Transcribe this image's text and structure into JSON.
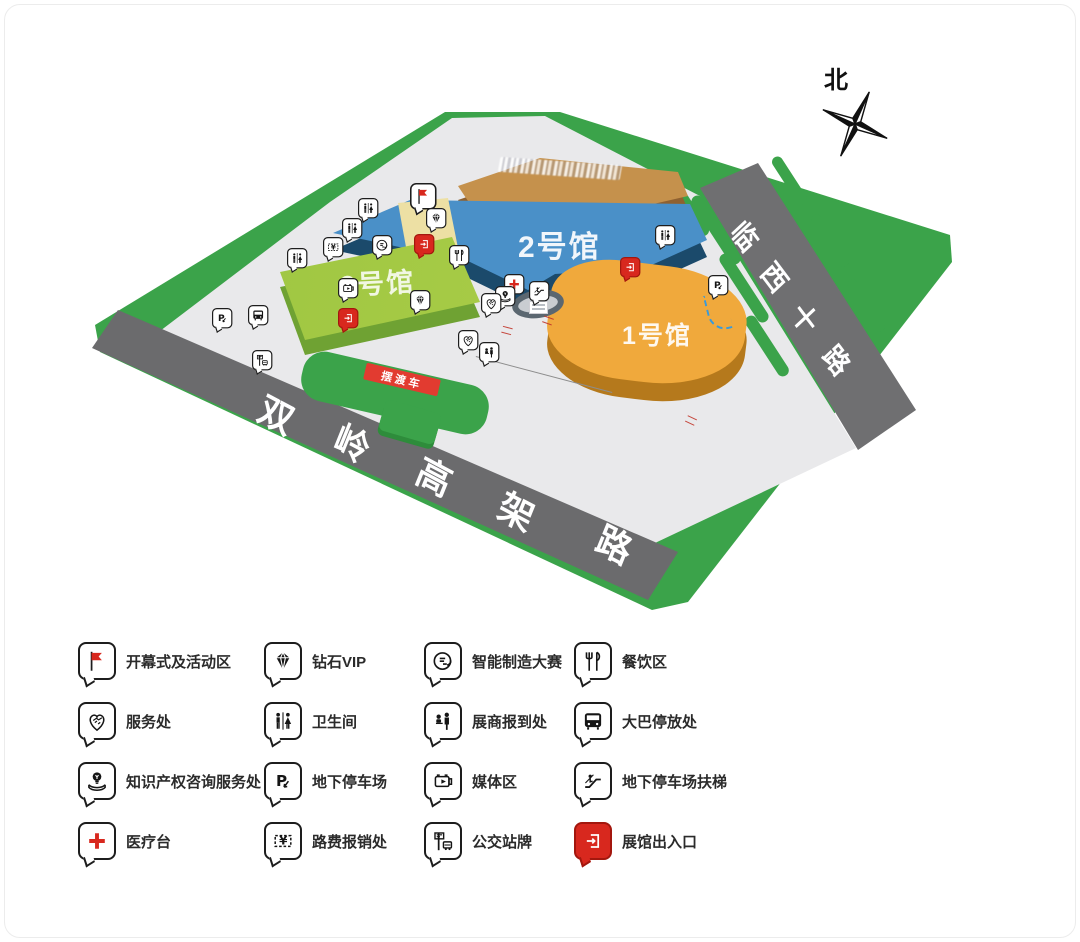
{
  "map": {
    "north_label": "北",
    "buildings": [
      {
        "id": "hall1",
        "label": "1号馆",
        "top_color": "#F0A93C",
        "front_color": "#B5791C"
      },
      {
        "id": "hall2",
        "label": "2号馆",
        "top_color": "#4A90C8",
        "front_color": "#1B4A6B"
      },
      {
        "id": "hall3",
        "label": "3号馆",
        "top_color": "#A9CC47",
        "front_color": "#6FA233"
      },
      {
        "id": "hotel",
        "label": "",
        "top_color": "#C5914C",
        "front_color": "#8F6130"
      }
    ],
    "roads": [
      {
        "id": "shuangling",
        "label": "双岭高架路"
      },
      {
        "id": "linxi",
        "label": "临西十路"
      }
    ],
    "shuttle_banner": "摆渡车",
    "colors": {
      "grass": "#3BA34A",
      "plaza": "#E9E9EB",
      "road": "#6E6E70",
      "flag_area": "#EDE0A4",
      "accent_red": "#D8281E",
      "dashed_arrow_blue": "#3A9AD9"
    },
    "pins": [
      {
        "icon": "flag",
        "x": 423,
        "y": 196,
        "big": true
      },
      {
        "icon": "diamond",
        "x": 436,
        "y": 218
      },
      {
        "icon": "restroom",
        "x": 368,
        "y": 208
      },
      {
        "icon": "restroom",
        "x": 352,
        "y": 228
      },
      {
        "icon": "ticket",
        "x": 333,
        "y": 247
      },
      {
        "icon": "smart",
        "x": 382,
        "y": 245
      },
      {
        "icon": "exit",
        "x": 424,
        "y": 244,
        "red": true
      },
      {
        "icon": "dining",
        "x": 459,
        "y": 255
      },
      {
        "icon": "restroom",
        "x": 297,
        "y": 258
      },
      {
        "icon": "media",
        "x": 348,
        "y": 288
      },
      {
        "icon": "diamond",
        "x": 420,
        "y": 300
      },
      {
        "icon": "exit",
        "x": 348,
        "y": 318,
        "red": true
      },
      {
        "icon": "service",
        "x": 468,
        "y": 340
      },
      {
        "icon": "medical",
        "x": 514,
        "y": 284
      },
      {
        "icon": "idea",
        "x": 505,
        "y": 296
      },
      {
        "icon": "service",
        "x": 491,
        "y": 303
      },
      {
        "icon": "checkin",
        "x": 489,
        "y": 352
      },
      {
        "icon": "escalator",
        "x": 539,
        "y": 291
      },
      {
        "icon": "restroom",
        "x": 665,
        "y": 235
      },
      {
        "icon": "exit",
        "x": 630,
        "y": 267,
        "red": true
      },
      {
        "icon": "parking",
        "x": 718,
        "y": 285
      },
      {
        "icon": "parking",
        "x": 222,
        "y": 318
      },
      {
        "icon": "bus",
        "x": 258,
        "y": 315
      },
      {
        "icon": "busstop",
        "x": 262,
        "y": 360
      }
    ]
  },
  "legend": {
    "items": [
      {
        "icon": "flag",
        "label": "开幕式及活动区"
      },
      {
        "icon": "diamond",
        "label": "钻石VIP"
      },
      {
        "icon": "smart",
        "label": "智能制造大赛"
      },
      {
        "icon": "dining",
        "label": "餐饮区"
      },
      {
        "icon": "service",
        "label": "服务处"
      },
      {
        "icon": "restroom",
        "label": "卫生间"
      },
      {
        "icon": "checkin",
        "label": "展商报到处"
      },
      {
        "icon": "bus",
        "label": "大巴停放处"
      },
      {
        "icon": "idea",
        "label": "知识产权咨询服务处"
      },
      {
        "icon": "parking",
        "label": "地下停车场"
      },
      {
        "icon": "media",
        "label": "媒体区"
      },
      {
        "icon": "escalator",
        "label": "地下停车场扶梯"
      },
      {
        "icon": "medical",
        "label": "医疗台"
      },
      {
        "icon": "ticket",
        "label": "路费报销处"
      },
      {
        "icon": "busstop",
        "label": "公交站牌"
      },
      {
        "icon": "exit",
        "label": "展馆出入口",
        "red": true
      }
    ]
  }
}
